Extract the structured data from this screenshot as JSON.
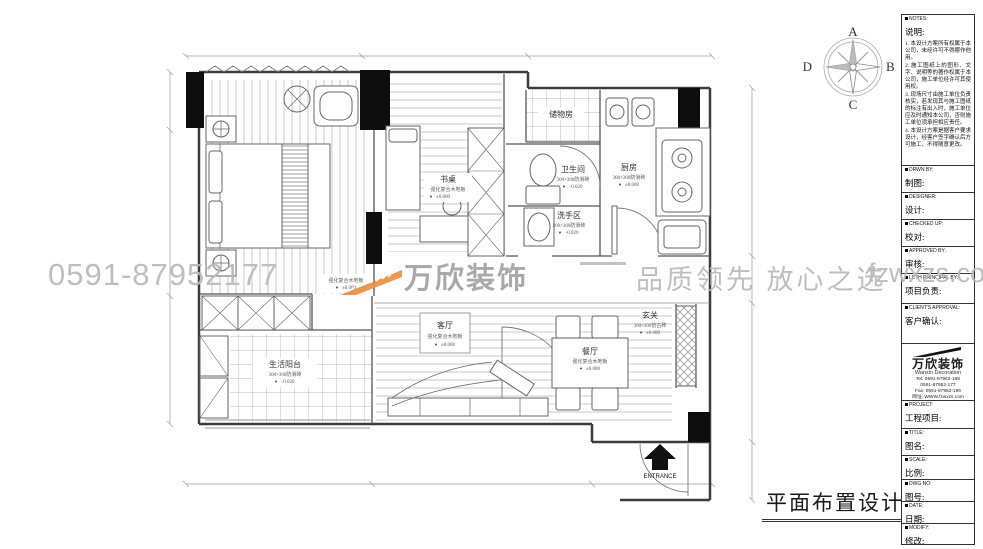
{
  "watermark": {
    "phone": "0591-87952177",
    "brand": "万欣装饰",
    "slogan": "品质领先 放心之选",
    "site": "fzwxzs.com"
  },
  "drawing_title": "平面布置设计图",
  "compass": {
    "top": "A",
    "right": "B",
    "bottom": "C",
    "left": "D"
  },
  "icons": {
    "level_marker": "▼"
  },
  "entrance_label": "ENTRANCE",
  "rooms": {
    "storage": {
      "name": "储物房"
    },
    "desk": {
      "name": "书桌",
      "material": "强化复合木地板",
      "level": "±0.000"
    },
    "bathroom": {
      "name": "卫生间",
      "material": "300×300防滑砖",
      "level": "-0.020"
    },
    "wash": {
      "name": "洗手区",
      "material": "300×300防滑砖",
      "level": "-0.020"
    },
    "kitchen": {
      "name": "厨房",
      "material": "300×300防滑砖",
      "level": "±0.000"
    },
    "living": {
      "name": "客厅",
      "material": "强化复合木地板",
      "level": "±0.000"
    },
    "dining": {
      "name": "餐厅",
      "material": "强化复合木地板",
      "level": "±0.000"
    },
    "entry": {
      "name": "玄关",
      "material": "300×300仿古砖",
      "level": "±0.000"
    },
    "balcony": {
      "name": "生活阳台",
      "material": "300×300防滑砖",
      "level": "-0.020"
    },
    "bedroom_note": {
      "material": "强化复合木地板",
      "level": "±0.000"
    }
  },
  "sidebar": {
    "notes": {
      "en": "NOTES:",
      "zh": "说明:",
      "items": [
        "1. 本设计方案所有权属于本公司，未经许可不得挪作他用。",
        "2. 施工图纸上的图形、文字、说明等的著作权属于本公司，施工单位经许可其使用权。",
        "3. 现场尺寸由施工单位负责核实，若发现其与施工图纸的标注有出入时，施工单位应及时通知本公司，否则施工单位须承担相应责任。",
        "4. 本设计方案是据客户要求设计，经客户签字确认后方可施工，不得随意更改。"
      ]
    },
    "fields": [
      {
        "en": "DRWN BY:",
        "zh": "制图:"
      },
      {
        "en": "DESIGNER:",
        "zh": "设计:"
      },
      {
        "en": "CHECKED UP:",
        "zh": "校对:"
      },
      {
        "en": "APPROVED BY:",
        "zh": "审核:"
      },
      {
        "en": "LETH PRINCIPAL BY:",
        "zh": "项目负责:"
      },
      {
        "en": "CLIENT'S APPROVAL:",
        "zh": "客户确认:"
      }
    ],
    "company": {
      "brand": "万欣装饰",
      "brand_en": "Wanxin Decoration",
      "lines": [
        "Tel: 0591-87952-166",
        "0591-87952-177",
        "Fax: 0591-87952-199",
        "网址: WWW.fzwxzs.com"
      ]
    },
    "fields2": [
      {
        "en": "PROJECT:",
        "zh": "工程项目:"
      },
      {
        "en": "TITLE:",
        "zh": "图名:"
      },
      {
        "en": "SCALE:",
        "zh": "比例:"
      },
      {
        "en": "DWG NO:",
        "zh": "图号:"
      },
      {
        "en": "DATE:",
        "zh": "日期:"
      },
      {
        "en": "MODIFY:",
        "zh": "修改:"
      }
    ]
  },
  "colors": {
    "accent_orange": "#ef8f3f",
    "watermark_gray": "#b9b9b9",
    "wall": "#3c3c3c"
  }
}
